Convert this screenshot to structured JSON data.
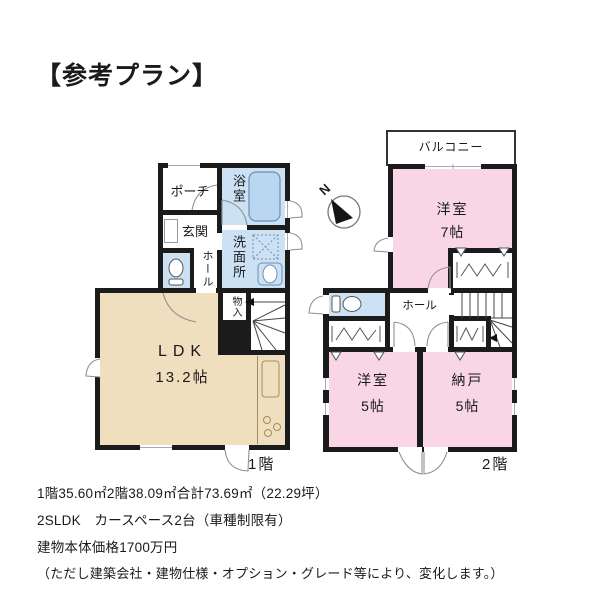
{
  "title": "【参考プラン】",
  "compass": {
    "label": "N"
  },
  "floor1": {
    "caption": "1階",
    "rooms": {
      "porch": "ポーチ",
      "entrance": "玄関",
      "bath": "浴室",
      "washroom": "洗面所",
      "hall": "ホール",
      "closet": "物入",
      "ldk_name": "LDK",
      "ldk_size": "13.2帖"
    }
  },
  "floor2": {
    "caption": "2階",
    "rooms": {
      "balcony": "バルコニー",
      "west_room7_name": "洋室",
      "west_room7_size": "7帖",
      "hall": "ホール",
      "west_room5_name": "洋室",
      "west_room5_size": "5帖",
      "storage_name": "納戸",
      "storage_size": "5帖"
    }
  },
  "footer": {
    "lines": [
      "1階35.60㎡2階38.09㎡合計73.69㎡（22.29坪）",
      "2SLDK　カースペース2台（車種制限有）",
      "建物本体価格1700万円",
      "（ただし建築会社・建物仕様・オプション・グレード等により、変化します。）"
    ]
  },
  "colors": {
    "wall": "#1b1b1b",
    "room-pink": "#f9d6e6",
    "room-blue": "#cde1f4",
    "room-beige": "#f0dfbe",
    "fixture-blue": "#b9d7f0",
    "fixture-stroke": "#6b8fb5",
    "line-gray": "#909090"
  }
}
